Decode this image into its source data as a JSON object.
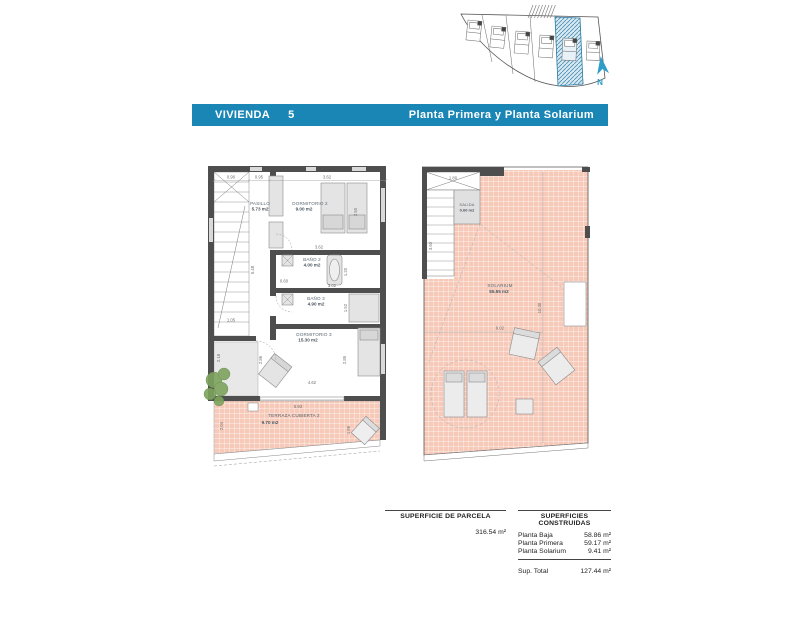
{
  "header": {
    "name": "VIVIENDA",
    "number": "5",
    "subtitle": "Planta Primera y Planta Solarium"
  },
  "site_plan": {
    "north_label": "N"
  },
  "planta_primera": {
    "rooms": {
      "pasillo": {
        "name": "PASILLO",
        "area": "5.73 m2"
      },
      "dormitorio2": {
        "name": "DORMITORIO 2",
        "area": "9.00 m2"
      },
      "bano2": {
        "name": "BAÑO 2",
        "area": "4.00 m2"
      },
      "bano3": {
        "name": "BAÑO 3",
        "area": "4.90 m2"
      },
      "dormitorio3": {
        "name": "DORMITORIO 3",
        "area": "15.30 m2"
      },
      "terraza": {
        "name": "TERRAZA CUBIERTA 2",
        "area": "9.70 m2"
      }
    },
    "dims": {
      "top1": "0.90",
      "top2": "0.95",
      "top3": "3.62",
      "stair": "5.48",
      "dorm2_h": "2.50",
      "bano2_w": "3.62",
      "bano2_h": "1.20",
      "pass": "0.60",
      "bano3_w": "3.02",
      "bano3_h": "1.52",
      "left1": "1.05",
      "left2": "2.18",
      "dorm3_h1": "2.86",
      "dorm3_h2": "2.85",
      "dorm3_w": "4.62",
      "terraza_w": "5.93",
      "terraza_h": "2.04",
      "chair": "1.86"
    }
  },
  "planta_solarium": {
    "rooms": {
      "salida": {
        "name": "SALIDA",
        "area": "0.60 m2"
      },
      "solarium": {
        "name": "SOLARIUM",
        "area": "55.55 m2"
      }
    },
    "dims": {
      "hatch_w": "1.80",
      "stair_h": "3.60",
      "right_h": "10.30",
      "width": "6.02"
    }
  },
  "summary": {
    "parcela_title": "SUPERFICIE DE PARCELA",
    "parcela_value": "316.54 m²",
    "construidas_title": "SUPERFICIES CONSTRUIDAS",
    "rows": [
      {
        "label": "Planta Baja",
        "value": "58.86 m²"
      },
      {
        "label": "Planta Primera",
        "value": "59.17 m²"
      },
      {
        "label": "Planta Solarium",
        "value": "9.41 m²"
      }
    ],
    "total_label": "Sup. Total",
    "total_value": "127.44 m²"
  },
  "colors": {
    "header_bar": "#1a86b6",
    "tile": "#f6c9b8",
    "wall": "#4e4e4e",
    "plot_hatch": "#4f93b8",
    "north_arrow": "#2f9dc8",
    "plant": "#7da45e"
  }
}
